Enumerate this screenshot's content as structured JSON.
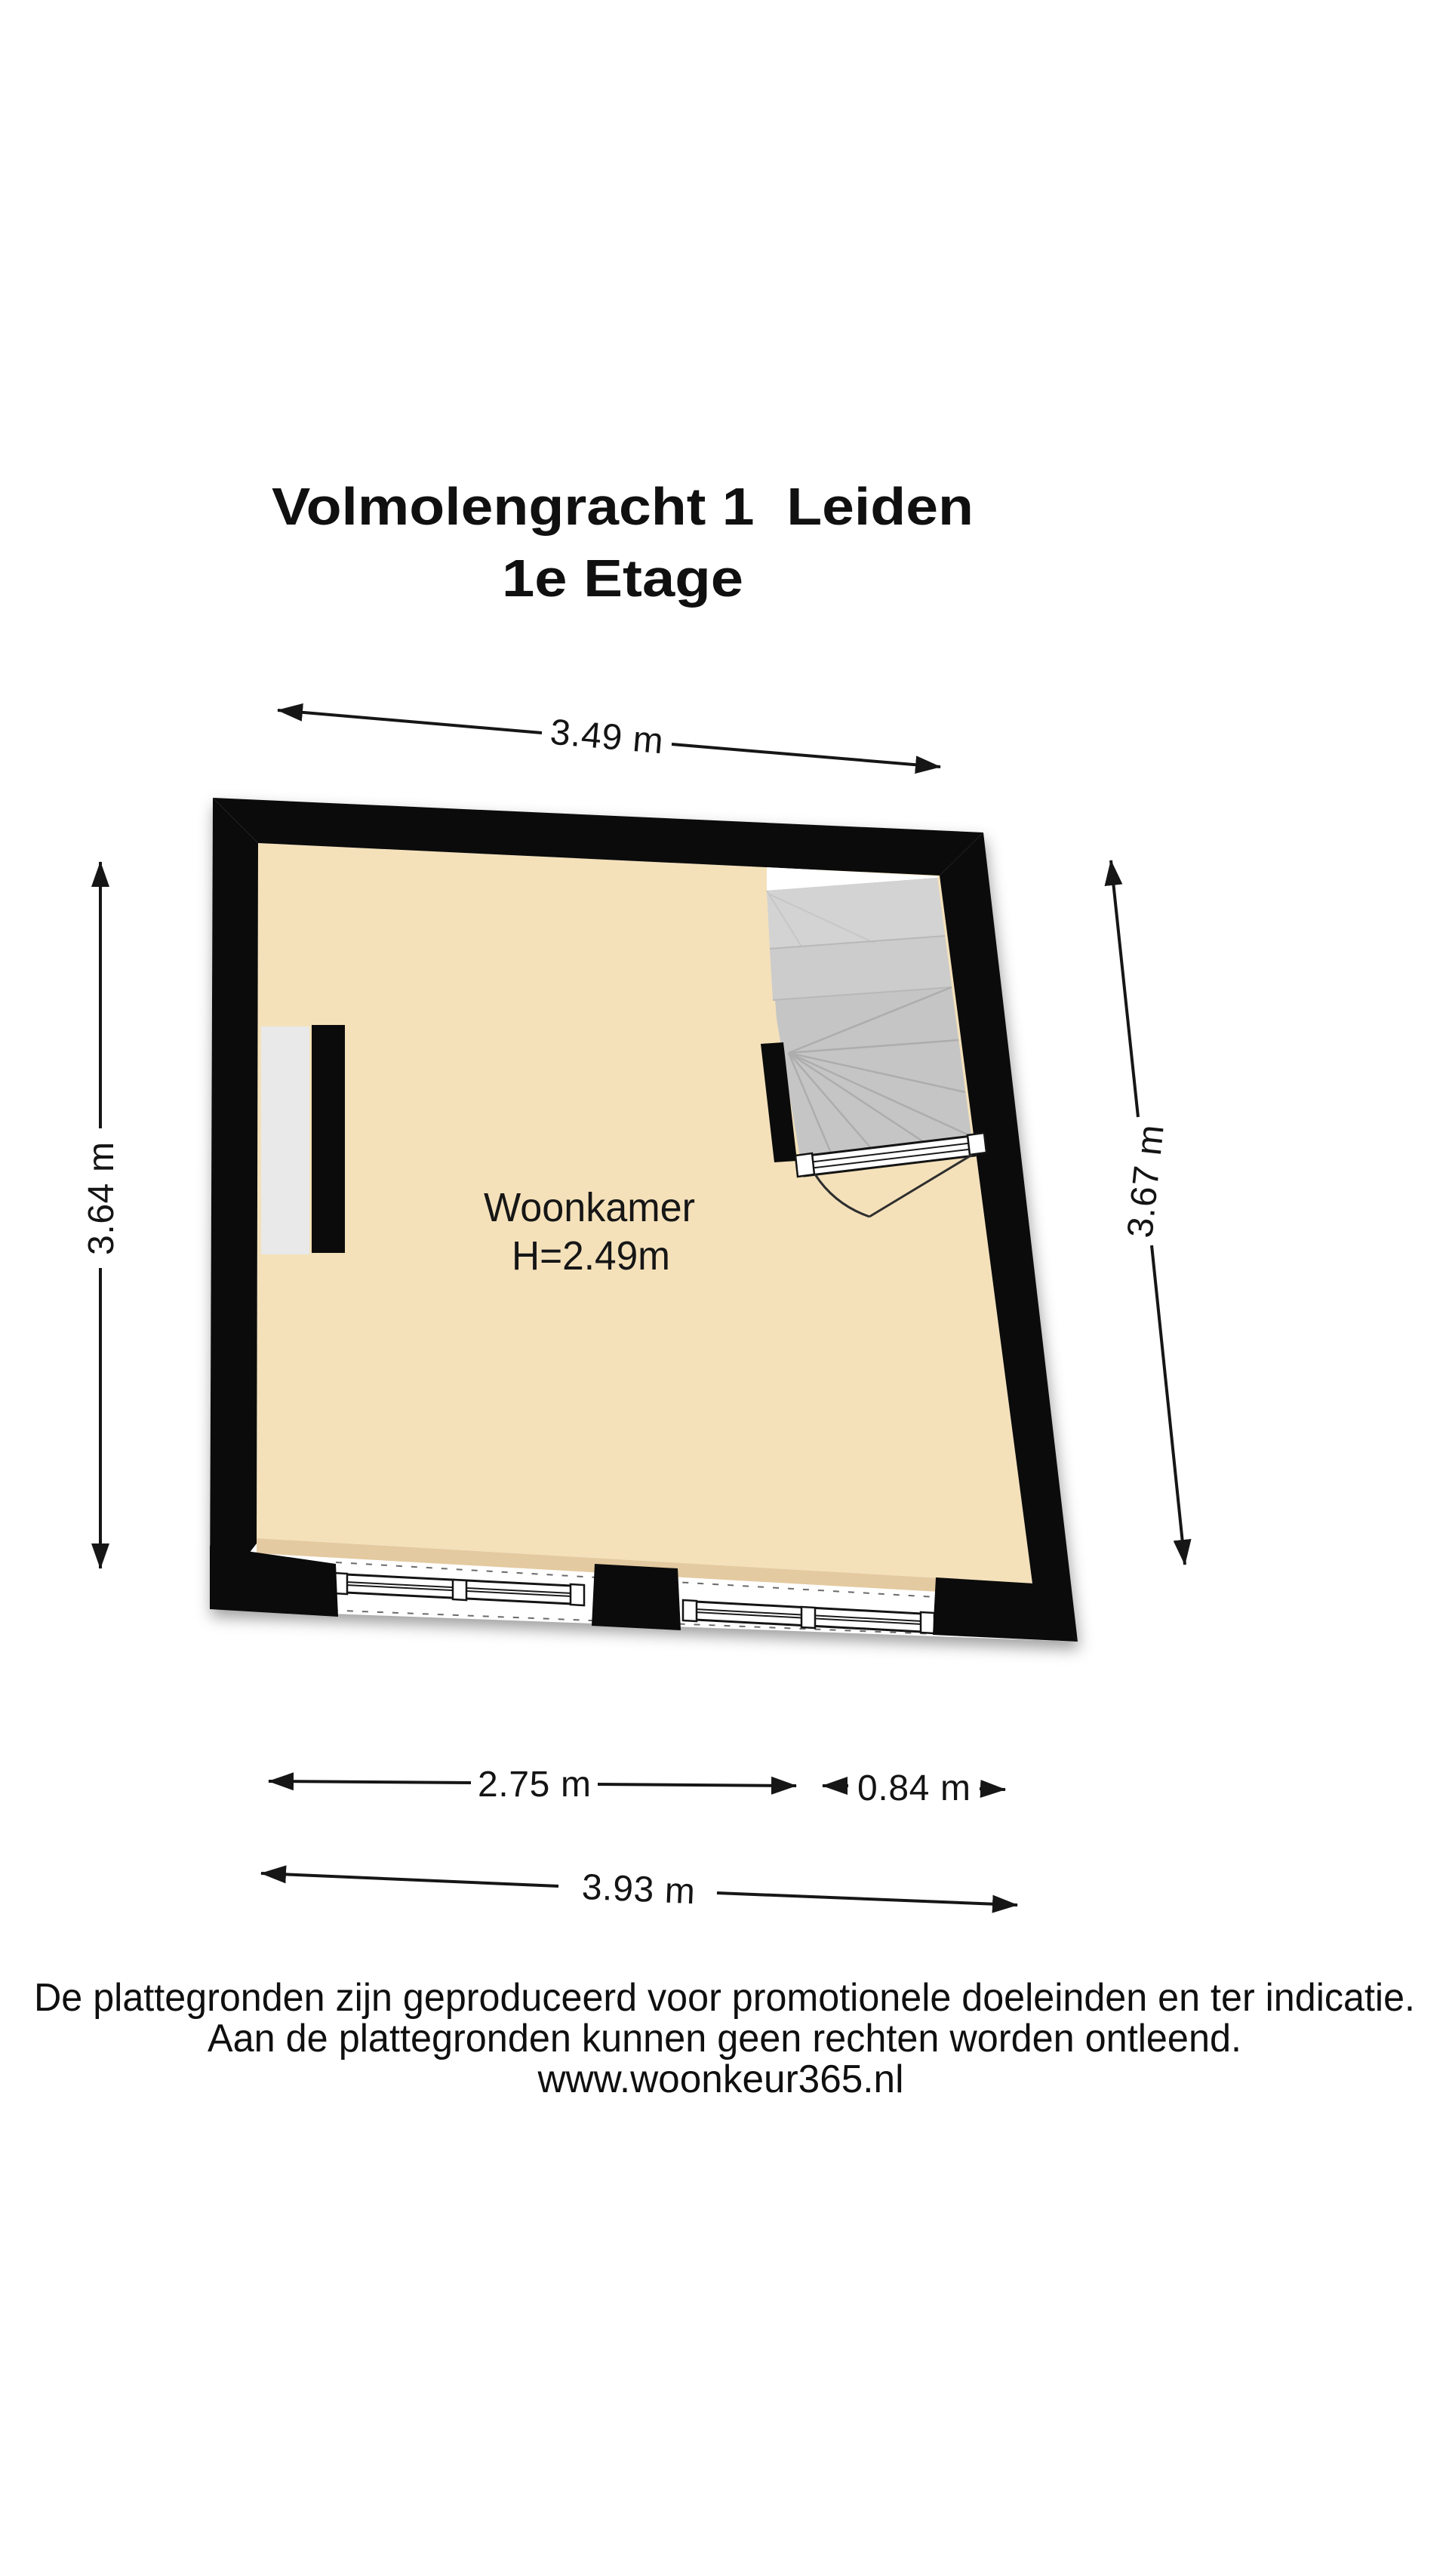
{
  "title": {
    "line1": "Volmolengracht 1  Leiden",
    "line2": "1e Etage"
  },
  "room": {
    "label": "Woonkamer",
    "ceiling_height": "H=2.49m"
  },
  "dimensions": {
    "top_width": "3.49 m",
    "left_height": "3.64 m",
    "right_height": "3.67 m",
    "bottom_window_width": "2.75 m",
    "bottom_stair_width": "0.84 m",
    "bottom_total_width": "3.93 m"
  },
  "footer": {
    "line1": "De plattegronden zijn geproduceerd voor promotionele doeleinden en ter indicatie.",
    "line2": "Aan de plattegronden kunnen geen rechten worden ontleend.",
    "line3": "www.woonkeur365.nl"
  },
  "colors": {
    "wall": "#0b0b0b",
    "floor": "#f4e1ba",
    "floor_shadow": "#e4caa0",
    "stairs": "#c5c5c5",
    "stairs_landing": "#d3d3d3",
    "stairs_step2": "#cccccc",
    "niche": "#e9e9e9",
    "paper": "#ffffff",
    "dimension_ink": "#141414"
  }
}
